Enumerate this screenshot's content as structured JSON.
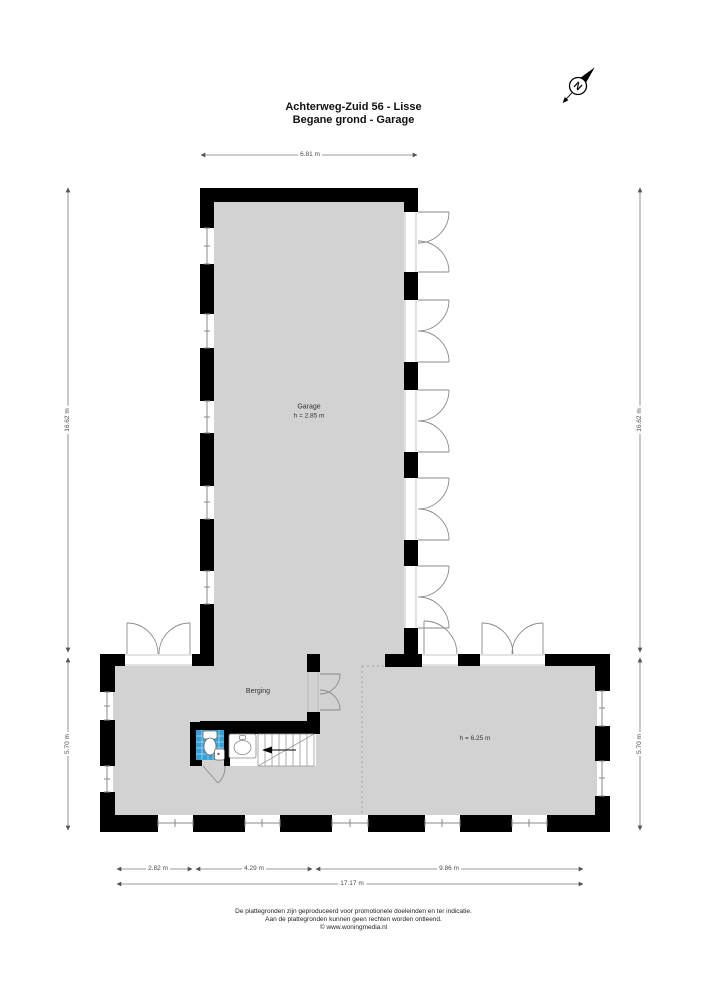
{
  "title": {
    "line1": "Achterweg-Zuid 56 - Lisse",
    "line2": "Begane grond - Garage"
  },
  "compass": {
    "letter": "N"
  },
  "rooms": {
    "garage": {
      "name": "Garage",
      "height": "h = 2.85 m"
    },
    "berging": {
      "name": "Berging"
    },
    "open_space": {
      "height": "h = 6.25 m"
    }
  },
  "dimensions": {
    "top_width": "6.81 m",
    "left_upper": "16.62 m",
    "left_lower": "5.70 m",
    "right_upper": "16.62 m",
    "right_lower": "5.70 m",
    "bottom_seg1": "2.82 m",
    "bottom_seg2": "4.29 m",
    "bottom_seg3": "9.86 m",
    "bottom_total": "17.17 m"
  },
  "footer": {
    "line1": "De plattegronden zijn geproduceerd voor promotionele doeleinden en ter indicatie.",
    "line2": "Aan de plattegronden kunnen geen rechten worden ontleend.",
    "line3": "© www.woningmedia.nl"
  },
  "colors": {
    "wall": "#000000",
    "floor": "#d2d2d2",
    "tile_blue": "#35a1d7",
    "dimension": "#666666"
  }
}
